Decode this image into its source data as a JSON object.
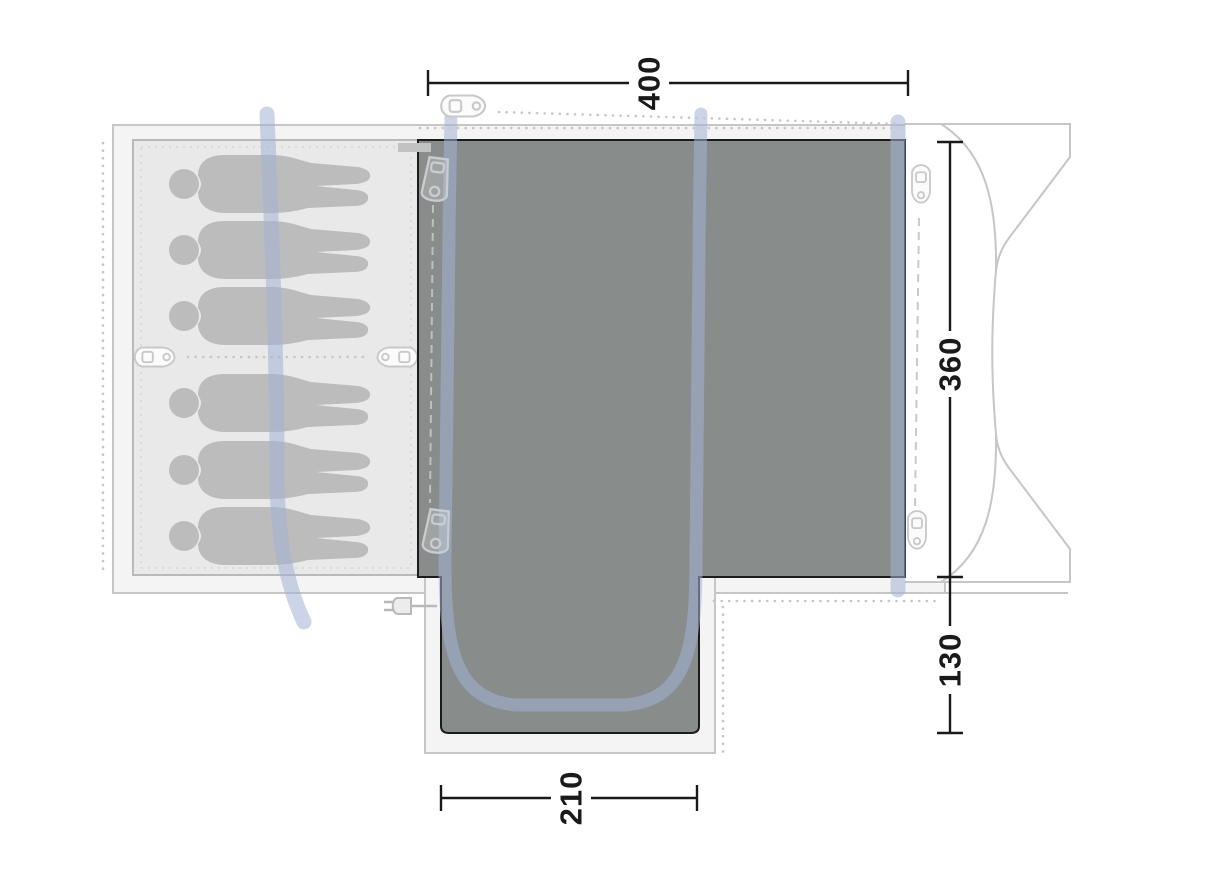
{
  "diagram": {
    "title": "tent-floorplan-top-view",
    "dimensions": {
      "width": "400",
      "depth": "360",
      "porch_depth": "130",
      "porch_width": "210"
    },
    "sleeping_capacity": 6,
    "icons": [
      "peg-icon",
      "zipper-pull-icon",
      "power-plug-icon",
      "pole-line",
      "person-silhouette"
    ],
    "colors": {
      "groundsheet_gray": "#888c8b",
      "groundsheet_border": "#1b1b1b",
      "cabin_fill": "#e9e9e9",
      "floor_fill": "#f4f4f4",
      "outline_gray": "#c6c6c6",
      "figure_gray": "#bcbcbc",
      "pole_blue": "#a2b3d6",
      "dimension_ink": "#1a1a1a"
    }
  }
}
